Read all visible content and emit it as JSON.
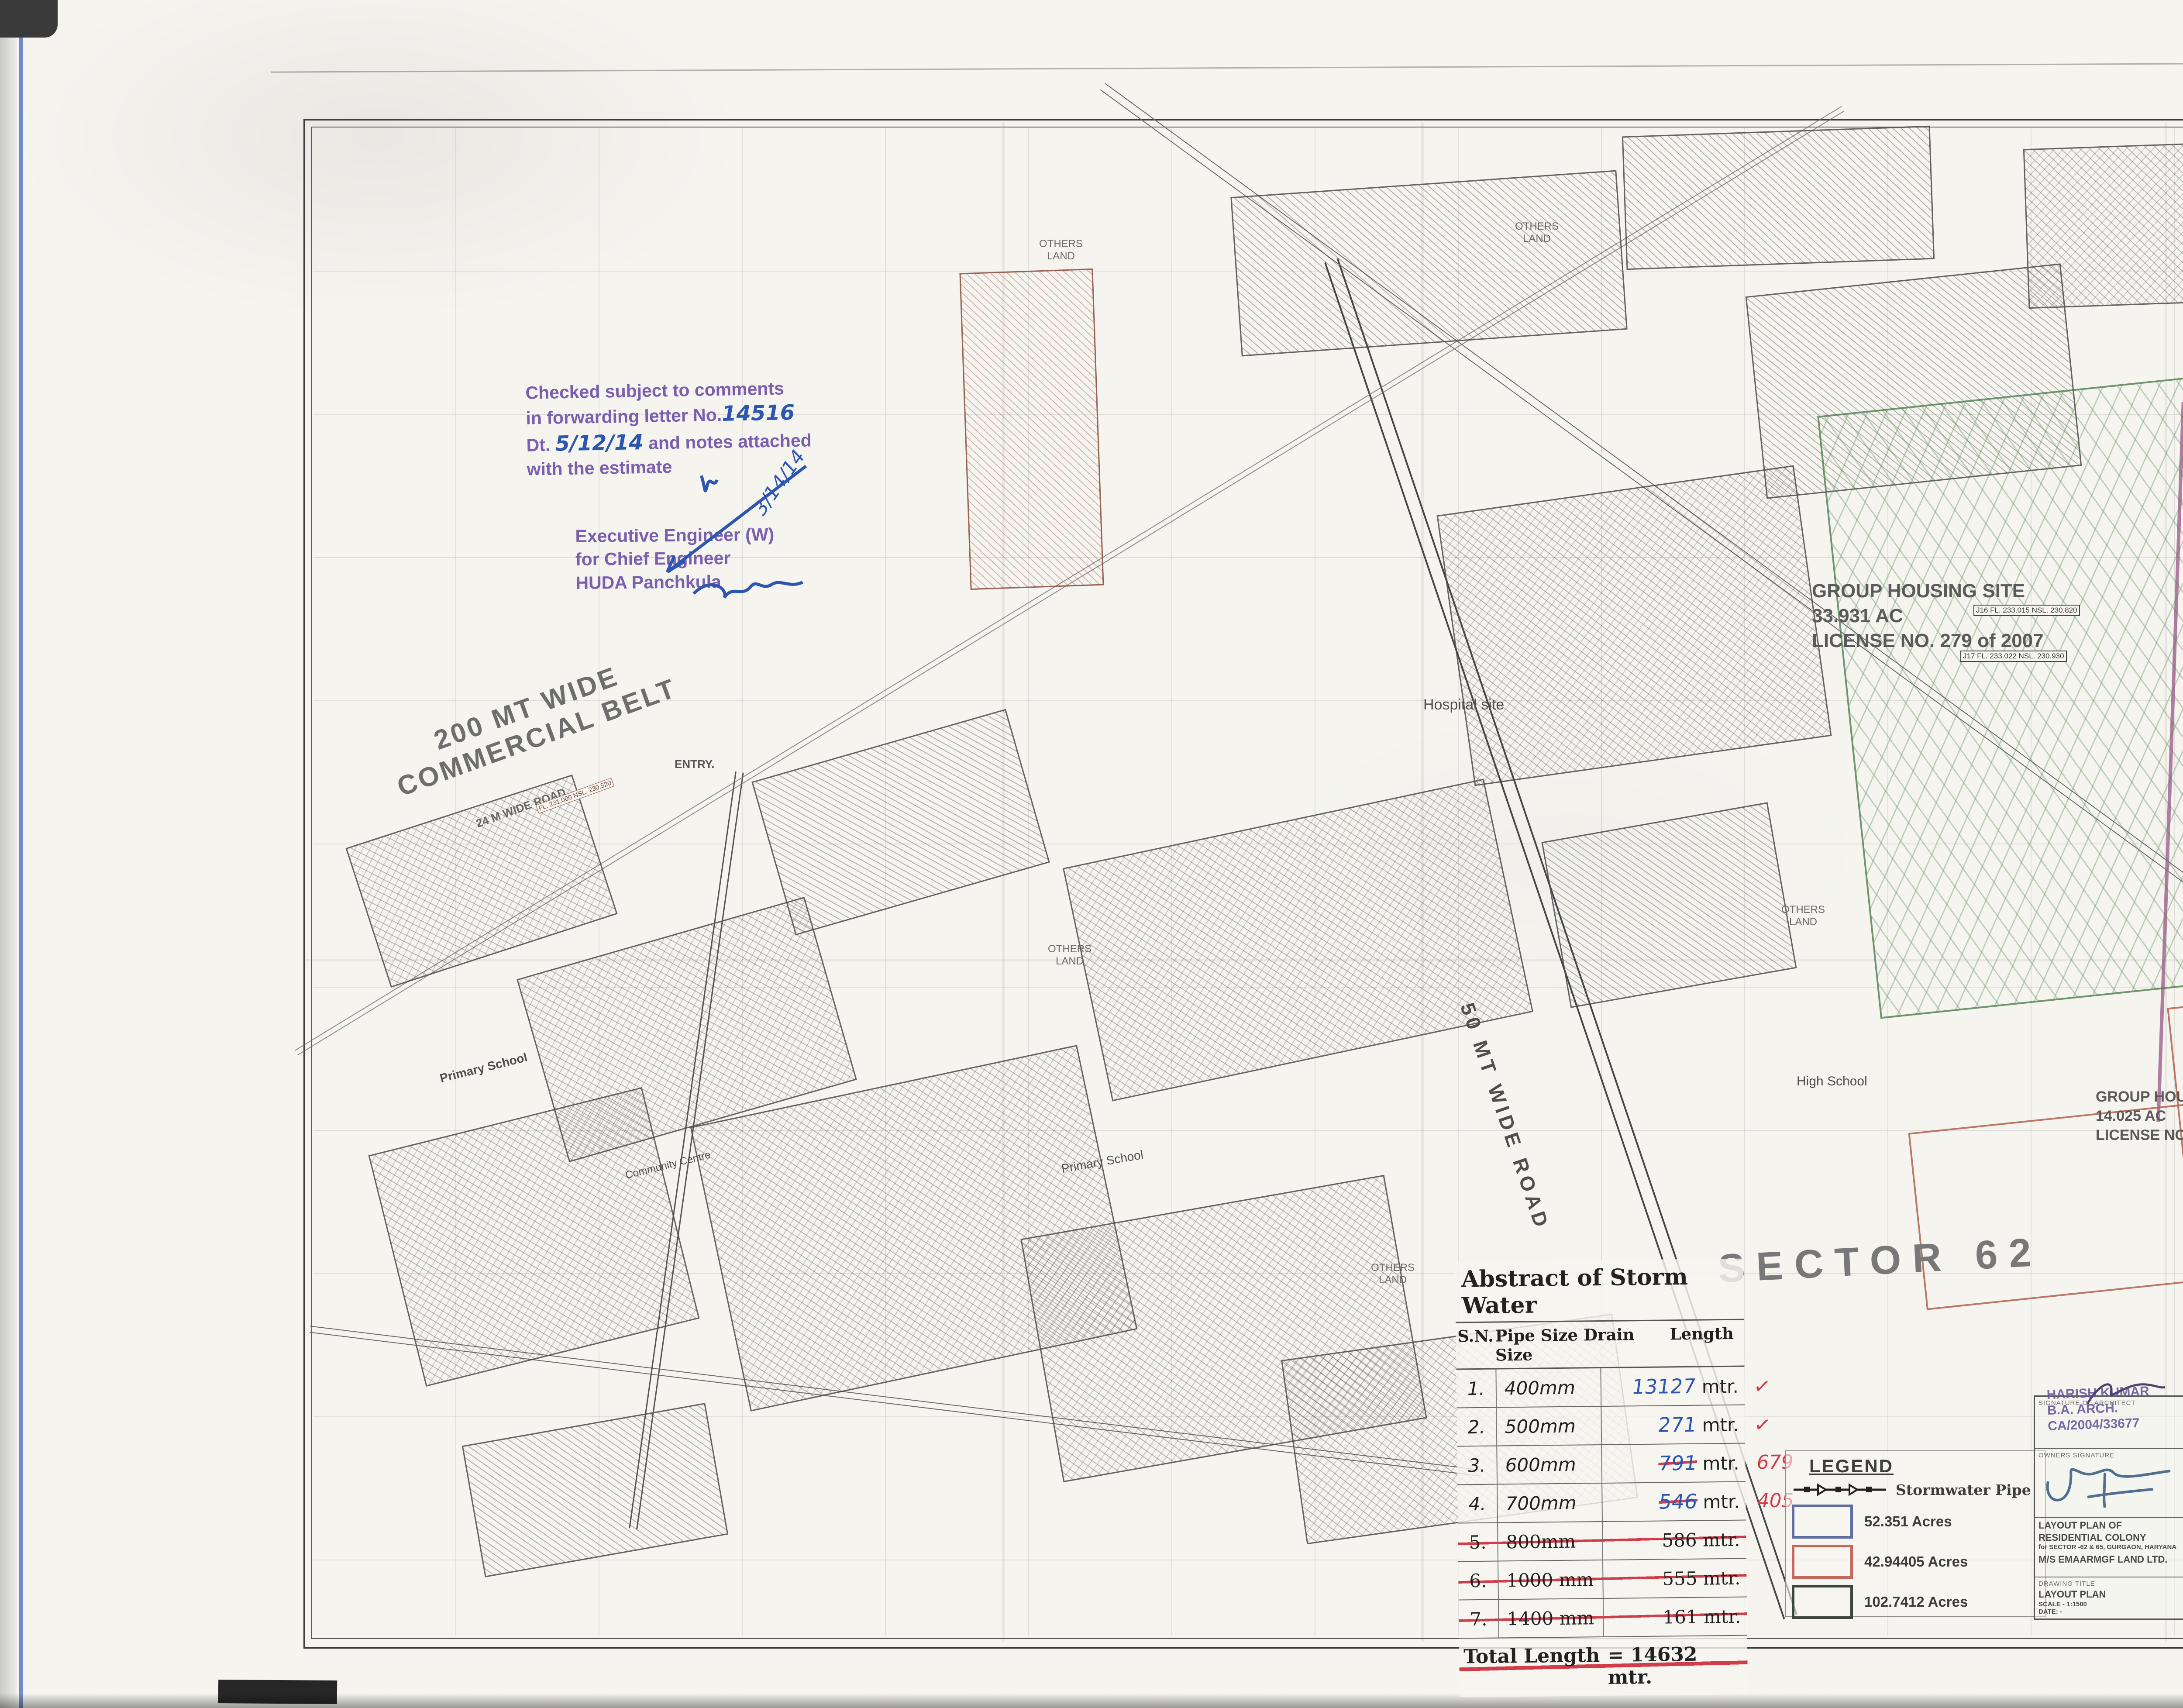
{
  "sheet": {
    "annotation_top": "Lc. 2170 VOL III / L.NO. 113 of 2011.  Dated :- 22/12/2011.",
    "title": "STORMWATER  LAYOUT  PLAN"
  },
  "tables": {
    "area_statement": {
      "title": "AREA STATEMENT",
      "headers": [
        "S.NO.",
        "DESCRIPTION",
        "AREA (ACRES)",
        "UNIT",
        "%",
        ""
      ],
      "rows": [
        [
          "1",
          "TOTAL AREA OF THE SCHEME",
          "198.03625",
          "ACRES",
          "",
          ""
        ],
        [
          "4",
          "Area under group Housing(A)",
          "9.5300",
          "ACRES",
          "",
          ""
        ],
        [
          "5",
          "AREA UNDER PLOTTED",
          "188.5063",
          "ACRES",
          "",
          ""
        ],
        [
          "6",
          "AREA UNDER UNDTERMINED USE",
          "11.7140",
          "ACRES",
          "",
          ""
        ],
        [
          "7",
          "Net area for Plotted",
          "176.7923",
          "ACRES",
          "",
          ""
        ],
        [
          "8",
          "AREA UNDER PLOTS (B)",
          "84.4746",
          "ACRES",
          "47.78%",
          ""
        ],
        [
          "9",
          "AREA UNDER NURSING HOME (C)",
          "0.9884",
          "ACRES",
          "0.56%",
          ""
        ],
        [
          "10",
          "AREA UNDER COMMERCIAL (D)",
          "7.072",
          "ACRES",
          "4.00%",
          ""
        ],
        [
          "11",
          "TOTAL SALEABLE AREA (B+C+D)",
          "92.5347",
          "ACRES",
          "52.34%",
          ""
        ]
      ]
    },
    "detail_of_plots": {
      "title": "DETAIL OF PLOTS",
      "h_sno": "S.NO.",
      "h_cat": "CATEGORY OF PLOT",
      "h_type": "Type",
      "h_area": "Area (Sq.yds)",
      "h_size": "SIZE OF PLOT (MT)",
      "h_width": "WIDTH",
      "h_depth": "DEPTH",
      "h_sqm": "AREA OF PLOTS (SQM)",
      "h_nos": "NOS.",
      "h_total": "TOTAL",
      "rows": [
        [
          "1",
          "TYPE A",
          "758",
          "19.8",
          "32",
          "633.600",
          "30",
          "19008.000"
        ],
        [
          "2",
          "TYPE A1",
          "1130",
          "21",
          "45",
          "945.000",
          "18",
          "17010.000"
        ],
        [
          "3",
          "TYPE A2",
          "1108",
          "16.75",
          "55.3",
          "926.275",
          "16",
          "14820.400"
        ],
        [
          "4",
          "TYPE A3",
          "1177",
          "18.4",
          "53.5",
          "984.400",
          "7",
          "6890.800"
        ],
        [
          "5",
          "TYPE B",
          "500",
          "15.24",
          "27.43",
          "418.033",
          "123",
          "51418.084"
        ],
        [
          "6",
          "TYPE B1",
          "698",
          "16.55",
          "35.25",
          "583.388",
          "17",
          "9917.588"
        ],
        [
          "7",
          "TYPE B2",
          "469",
          "14.62",
          "26.82",
          "392.108",
          "8",
          "3136.867"
        ],
        [
          "7",
          "TYPE C",
          "400",
          "12.2",
          "27.43",
          "334.646",
          "113",
          "37814.998"
        ],
        [
          "8",
          "TYPE D",
          "351",
          "10.69",
          "27.43",
          "293.227",
          "333",
          "97644.491"
        ],
        [
          "",
          "TYPE E",
          "151",
          "8.45",
          "14.95",
          "126.328",
          "96",
          "12127.440"
        ],
        [
          "10",
          "TYPE F",
          "267",
          "10.45",
          "21.34",
          "223.003",
          "264",
          "58872.792"
        ],
        [
          "11",
          "TYPE G (EWS)",
          "60",
          "4.56",
          "11",
          "50.160",
          "263",
          "13192.080"
        ],
        [
          "12",
          "",
          "",
          "",
          "",
          "",
          "",
          ""
        ]
      ],
      "total_sn": "13",
      "total_label": "TOTAL NO. OF PLOTS",
      "total_nos": "1288",
      "total_val": "341853.539",
      "net_sn": "14",
      "net_label": "NET AREA UNDER PLOTS (IN ACRES)",
      "net_val": "84.4746",
      "pop_sn": "15",
      "pop_label": "TOTAL POPULATION PPA"
    },
    "npnl": {
      "title": "DETAIL OF NPNL & EWS PLOTS",
      "headers": [
        "TYPE",
        "REQUIRED",
        "PROVIDED",
        "",
        ""
      ],
      "rows": [
        [
          "EWS",
          "258",
          "263",
          "",
          ""
        ],
        [
          "NPNL",
          "322",
          "322",
          "",
          ""
        ]
      ]
    },
    "population": {
      "title": "POPULATION",
      "rows": [
        [
          "NO. OF PLOTS OTHER THAN EWS =",
          "1025",
          "x",
          "13.5",
          "13837.5"
        ],
        [
          "EWS PLOTS =",
          "263",
          "x",
          "9",
          "2367"
        ],
        [
          "TOTAL POPULATION",
          "",
          "",
          "",
          "16204.5"
        ]
      ],
      "density_label": "DENSITY",
      "density_a": "16204.5",
      "density_op": "/",
      "density_b": "176.7923",
      "density_eq": "=",
      "density_res": "91.65843 PPA",
      "against": "AGAINST 96 PPA PERMISSIBLE"
    },
    "density_cf": {
      "title": "Demsity for Community facilities",
      "row_label": "Total of Plotted & GH @250 PPA",
      "v1": "16204.5",
      "v2": "2382.5",
      "v3": "18587"
    },
    "community": {
      "title": "COMMUNITY FACILITIES",
      "headers": [
        "S.No.",
        "",
        "REQUIRED",
        "PROVIDED",
        "Area",
        "Total Area requriement"
      ],
      "rows": [
        [
          "1",
          "NURSERY SCHOOL",
          "4",
          "4",
          "0.2",
          "0.80"
        ],
        [
          "2",
          "PRIMARY SCHOOL",
          "2",
          "2",
          "1",
          "2.00"
        ],
        [
          "3",
          "High School",
          "1",
          "1",
          "5",
          "5.00"
        ],
        [
          "4",
          "Dispensary",
          "1",
          "1",
          "1.25",
          "1.25"
        ],
        [
          "5",
          "Creche",
          "1",
          "1",
          "0.2",
          "0.20"
        ],
        [
          "6",
          "Religious Buliding",
          "1",
          "1",
          "0.2",
          "0.20"
        ],
        [
          "7",
          "Club Comunnity Centre",
          "1",
          "1",
          "2",
          "2.00"
        ],
        [
          "8",
          "S. Post Office",
          "1",
          "1",
          "0.01",
          "0.01"
        ],
        [
          "9",
          "Nursing Home",
          "4",
          "4",
          "0.247",
          "0.99"
        ],
        [
          "10",
          "Taxi Stand",
          "2",
          "2",
          "0.5",
          "1.00"
        ]
      ],
      "total": "13.45"
    },
    "parks": {
      "title": "DETAILS OF PARKS",
      "headers": [
        "DESCRIPTION",
        "AREA (Sq.Mt)",
        "Area (Acres)"
      ],
      "rows": [
        [
          "Park-1",
          "4069",
          "1.005"
        ],
        [
          "Park-2",
          "4098",
          "1.013"
        ],
        [
          "Park-3",
          "4082",
          "1.009"
        ],
        [
          "Park-4",
          "4725",
          "1.168"
        ],
        [
          "Park-5",
          "7848",
          "1.939"
        ],
        [
          "Park-6",
          "4437",
          "1.096"
        ]
      ],
      "total_label": "Total",
      "total_sqm": "29259",
      "total_acres": "7.230",
      "consol_label": "Consolidated Park Area of Total Site",
      "consol_val": "4.09%"
    }
  },
  "notes": {
    "header": "LC-2170 Vol III / L.No. 113 of 2011   Dated : 22/12/2011.",
    "intro": "That this Layout Plan for an area of 198.033625 acres (Drg. No. DG,TCP-2789 dated 20.9.2011) comprised of licenses which were issued in respect of Residential Colony being developed by M/s Emaar MGF Land Ltd. in Sector-62 & 65, Gurgaon Manesar Urban Complex is hereby approved subject to the following conditions:-",
    "items": [
      {
        "n": "1.",
        "t": "That this Layout Plan shall be read in conjunction with the clauses appearing on the agreement executed under Rule 11 and the bilateral agreement."
      },
      {
        "n": "2.",
        "t": "That the plotted area of the colony shall not exceed 55% of the net planned area of the colony. The entire area reserved for commercial purposes shall be taken as plotted for calculation of the area under plots."
      },
      {
        "n": "3.",
        "t": "That the demarcation plans as per site of all the residential, commercial and institutional sites shall be got approved from this Department and construction on these sites shall be governed by the Punjab Scheduled Roads and Controlled Areas Restriction of Unregulated Development Rules, 1965 and the Zoning Plan approved by the Director General, Town & Country Planning, Haryana."
      },
      {
        "n": "4.",
        "t": "That the high-tension lines passing in the colony area shall have to be suitably aligned or right of way along the same shall be maintained as per ISI norms."
      },
      {
        "n": "5.",
        "t": "That for proper planning and integration of services in the area adjacent to the colony, the colonizer shall abide by the directions of the DG,TCP for the modification of layout plans of the colony."
      },
      {
        "n": "6.",
        "t": "That the revenue rasta falling in the colony shall be kept free for circulation/movement as shown in the layout plan."
      },
      {
        "n": "7.",
        "t": "That the colonizer shall abide by the directions of the DG,TCP, Haryana and accordingly shall make necessary changes in the layout plan for making any adjustment in the alignment of the peripheral roads, internal road circulation or for proper integration of the planning proposals of the adjoining areas of the sectors as shown on the Development Plan."
      },
      {
        "n": "8.",
        "t": "That no property/plot shall derive access directly from the carriage way of 30 metres or more wide sector road."
      },
      {
        "n": "9.",
        "t": "All green belts provided in the layout plan within the licenced areas of the colony shall be developed by the colonizer. All other green belts outside the licenced area shall be developed by the Haryana Urban Development Authority/colonizer on the directions of the Director General, Town & Country Planning Haryana or in accordance with terms and conditions of the agreements of the licenses."
      },
      {
        "n": "10.",
        "t": "At the time of demarcation, if required percentage of NPNL/ EWS plots and the area under infrastructure are reduced, the same will be provided by the colonizer in the licenced area."
      },
      {
        "n": "11.",
        "t": "Any excess area over and above the permissible 4% under commercial use shall be deemed to be open space."
      },
      {
        "n": "12.",
        "t": "The maximum number of dwelling units in a plot shall be as per the provisions of the Rule 49 of the Rules, 1965. This condition shall also be incorporated in the zoning plan and in the allotment letters being issued by the coloniser to the plot holders. The stipulation shall also be incorporated in the agreement to be executed by the coloniser with the plot buyers."
      },
      {
        "n": "13.",
        "t": "No plot will derive an access from less than 12 metres wide road would mean a minimum clear width of 12 metres between the plots."
      },
      {
        "n": "14.",
        "t": "The portion of the sector/development plan roads /green belts as provided in the Development Plan, which form part of the licenced area shall be transferred free of cost to the government on the lines of section 3(3)(a)(iii) of the Act No.8 of 1975."
      },
      {
        "n": "15.",
        "t": "That the odd size plots (except EWS plots which are approved of standard dimensions) are being approved subject to the conditions that these plots should not have a frontage of less than 75% of the standard frontage when demarcated and area of no plot shall exceed 2 kanals."
      },
      {
        "n": "16.",
        "t": "That you will have no objection to the regularization of the boundaries of the licence through give and take with the land that HUDA is finally able to acquire in the interest of planned development and integration of services. The decision of the competent authority shall be binding in this regard."
      },
      {
        "n": "17.",
        "t": "That the coloniser shall obtain the clearance/NOC as per the provisions of the Notification No. S.O. 1533 (E) Dated 14.9.2006 issued by Ministry of Environment and Forest, Government of India before starting the construction/execution of development works at site."
      },
      {
        "n": "18.",
        "t": "That the rain water harvesting system shall be provided as per Central Ground Water Authority norms/Haryana Govt. notification as applicable."
      },
      {
        "n": "19.",
        "t": "That the provision of solar water heating system shall be as per norms specified by HAREDA and shall be made operational where applicable before applying for an occupation certificate."
      },
      {
        "n": "20.",
        "t": "That the coloniser/owner shall use only Compact Fluorescent Lamps fitting for internal lighting as well as Campus lighting."
      },
      {
        "n": "21.",
        "t": "That you shall convey the ultimate power load requirement of your power utility to enable the provision of project to the concerned site for transformer/switching station /electric sub station as per the norms prescribed by the power utility in your project site within three months from the approval of zoning plan."
      }
    ]
  },
  "approvals": [
    {
      "name": "(JITENDER SIHAG)",
      "role": "DTP (HQ)"
    },
    {
      "name": "(J. S. REDHU)",
      "role": "CTP (HR)"
    },
    {
      "name": "(T. C. GUPTA, IAS)",
      "role": "DG,TCP (HR)"
    }
  ],
  "abstract": {
    "title": "Abstract of Storm Water",
    "h_sn": "S.N.",
    "h_size": "Pipe Size Drain Size",
    "h_len": "Length",
    "rows": [
      {
        "sn": "1.",
        "size": "400mm",
        "len": "13127",
        "unit": "mtr.",
        "mark": "✓",
        "_cls": "hand check"
      },
      {
        "sn": "2.",
        "size": "500mm",
        "len": "271",
        "unit": "mtr.",
        "mark": "✓",
        "_cls": "hand check"
      },
      {
        "sn": "3.",
        "size": "600mm",
        "len": "791",
        "unit": "mtr.",
        "corr": "679",
        "_cls": "hand struck"
      },
      {
        "sn": "4.",
        "size": "700mm",
        "len": "546",
        "unit": "mtr.",
        "corr": "405",
        "_cls": "hand struck"
      },
      {
        "sn": "5.",
        "size": "800mm",
        "len": "586",
        "unit": "mtr.",
        "_cls": "struck-all"
      },
      {
        "sn": "6.",
        "size": "1000 mm",
        "len": "555",
        "unit": "mtr.",
        "_cls": "struck-all"
      },
      {
        "sn": "7.",
        "size": "1400 mm",
        "len": "161",
        "unit": "mtr.",
        "_cls": "struck-all"
      }
    ],
    "total_label": "Total  Length",
    "total_value": "=  14632 mtr."
  },
  "legend": {
    "title": "LEGEND",
    "pipe_label": "Stormwater Pipe",
    "items": [
      {
        "color": "#5f6da3",
        "label": "52.351 Acres"
      },
      {
        "color": "#c4685c",
        "label": "42.94405  Acres"
      },
      {
        "color": "#3c463c",
        "label": "102.7412 Acres"
      }
    ]
  },
  "title_block": {
    "architect_label": "SIGNATURE OF ARCHITECT",
    "architect_stamp": [
      "HARISH KUMAR",
      "B.A. ARCH.",
      "CA/2004/33677"
    ],
    "owners_label": "OWNERS SIGNATURE",
    "project_1": "LAYOUT PLAN OF",
    "project_2": "RESIDENTIAL COLONY",
    "project_3": "for SECTOR -62 & 65, GURGAON, HARYANA",
    "project_4": "M/S EMAARMGF LAND LTD.",
    "drawing_title_label": "DRAWING TITLE",
    "drawing_title": "LAYOUT PLAN",
    "scale": "SCALE - 1:1500",
    "date": "DATE: -",
    "north": "N"
  },
  "stamps": {
    "service_note": "For service estimate only",
    "ee_division": [
      "Executive Engineer",
      "HUDA Division No. I",
      "GURGAON"
    ],
    "se_circle": [
      "Superintending Engineer,",
      "HUDA, Circle-II, Gurgaon"
    ],
    "checked_1": "Checked subject to comments",
    "checked_2a": "in forwarding letter No.",
    "checked_no": "14516",
    "checked_3a": "Dt.",
    "checked_dt": "5/12/14",
    "checked_3b": "and notes attached",
    "checked_4": "with the estimate",
    "eew": [
      "Executive Engineer (W)",
      "for Chief Engineer",
      "HUDA Panchkula"
    ],
    "eew_date": "3/14/14"
  },
  "plan": {
    "labels": {
      "commercial_belt_1": "200 MT  WIDE",
      "commercial_belt_2": "COMMERCIAL BELT",
      "road50": "50 MT WIDE ROAD",
      "road24": "24 M WIDE ROAD",
      "entry": "ENTRY.",
      "hospital": "Hospital site",
      "primary_school": "Primary School",
      "community_centre": "Community Centre",
      "high_school": "High School",
      "sector": "SECTOR  62",
      "gh1_1": "GROUP HOUSING SITE",
      "gh1_2": "33.931 AC",
      "gh1_3": "LICENSE NO. 279 of 2007",
      "gh2_1": "GROUP HOUSING SITE",
      "gh2_2": "14.025 AC",
      "gh2_3": "LICENSE NO. 265 of 2007",
      "others_land": "OTHERS LAND",
      "j16": "J16  FL. 233.015  NSL. 230.820",
      "j17": "J17  FL. 233.022  NSL. 230.930",
      "fl_tag": "FL. 231.000  NSL. 230.520"
    }
  }
}
